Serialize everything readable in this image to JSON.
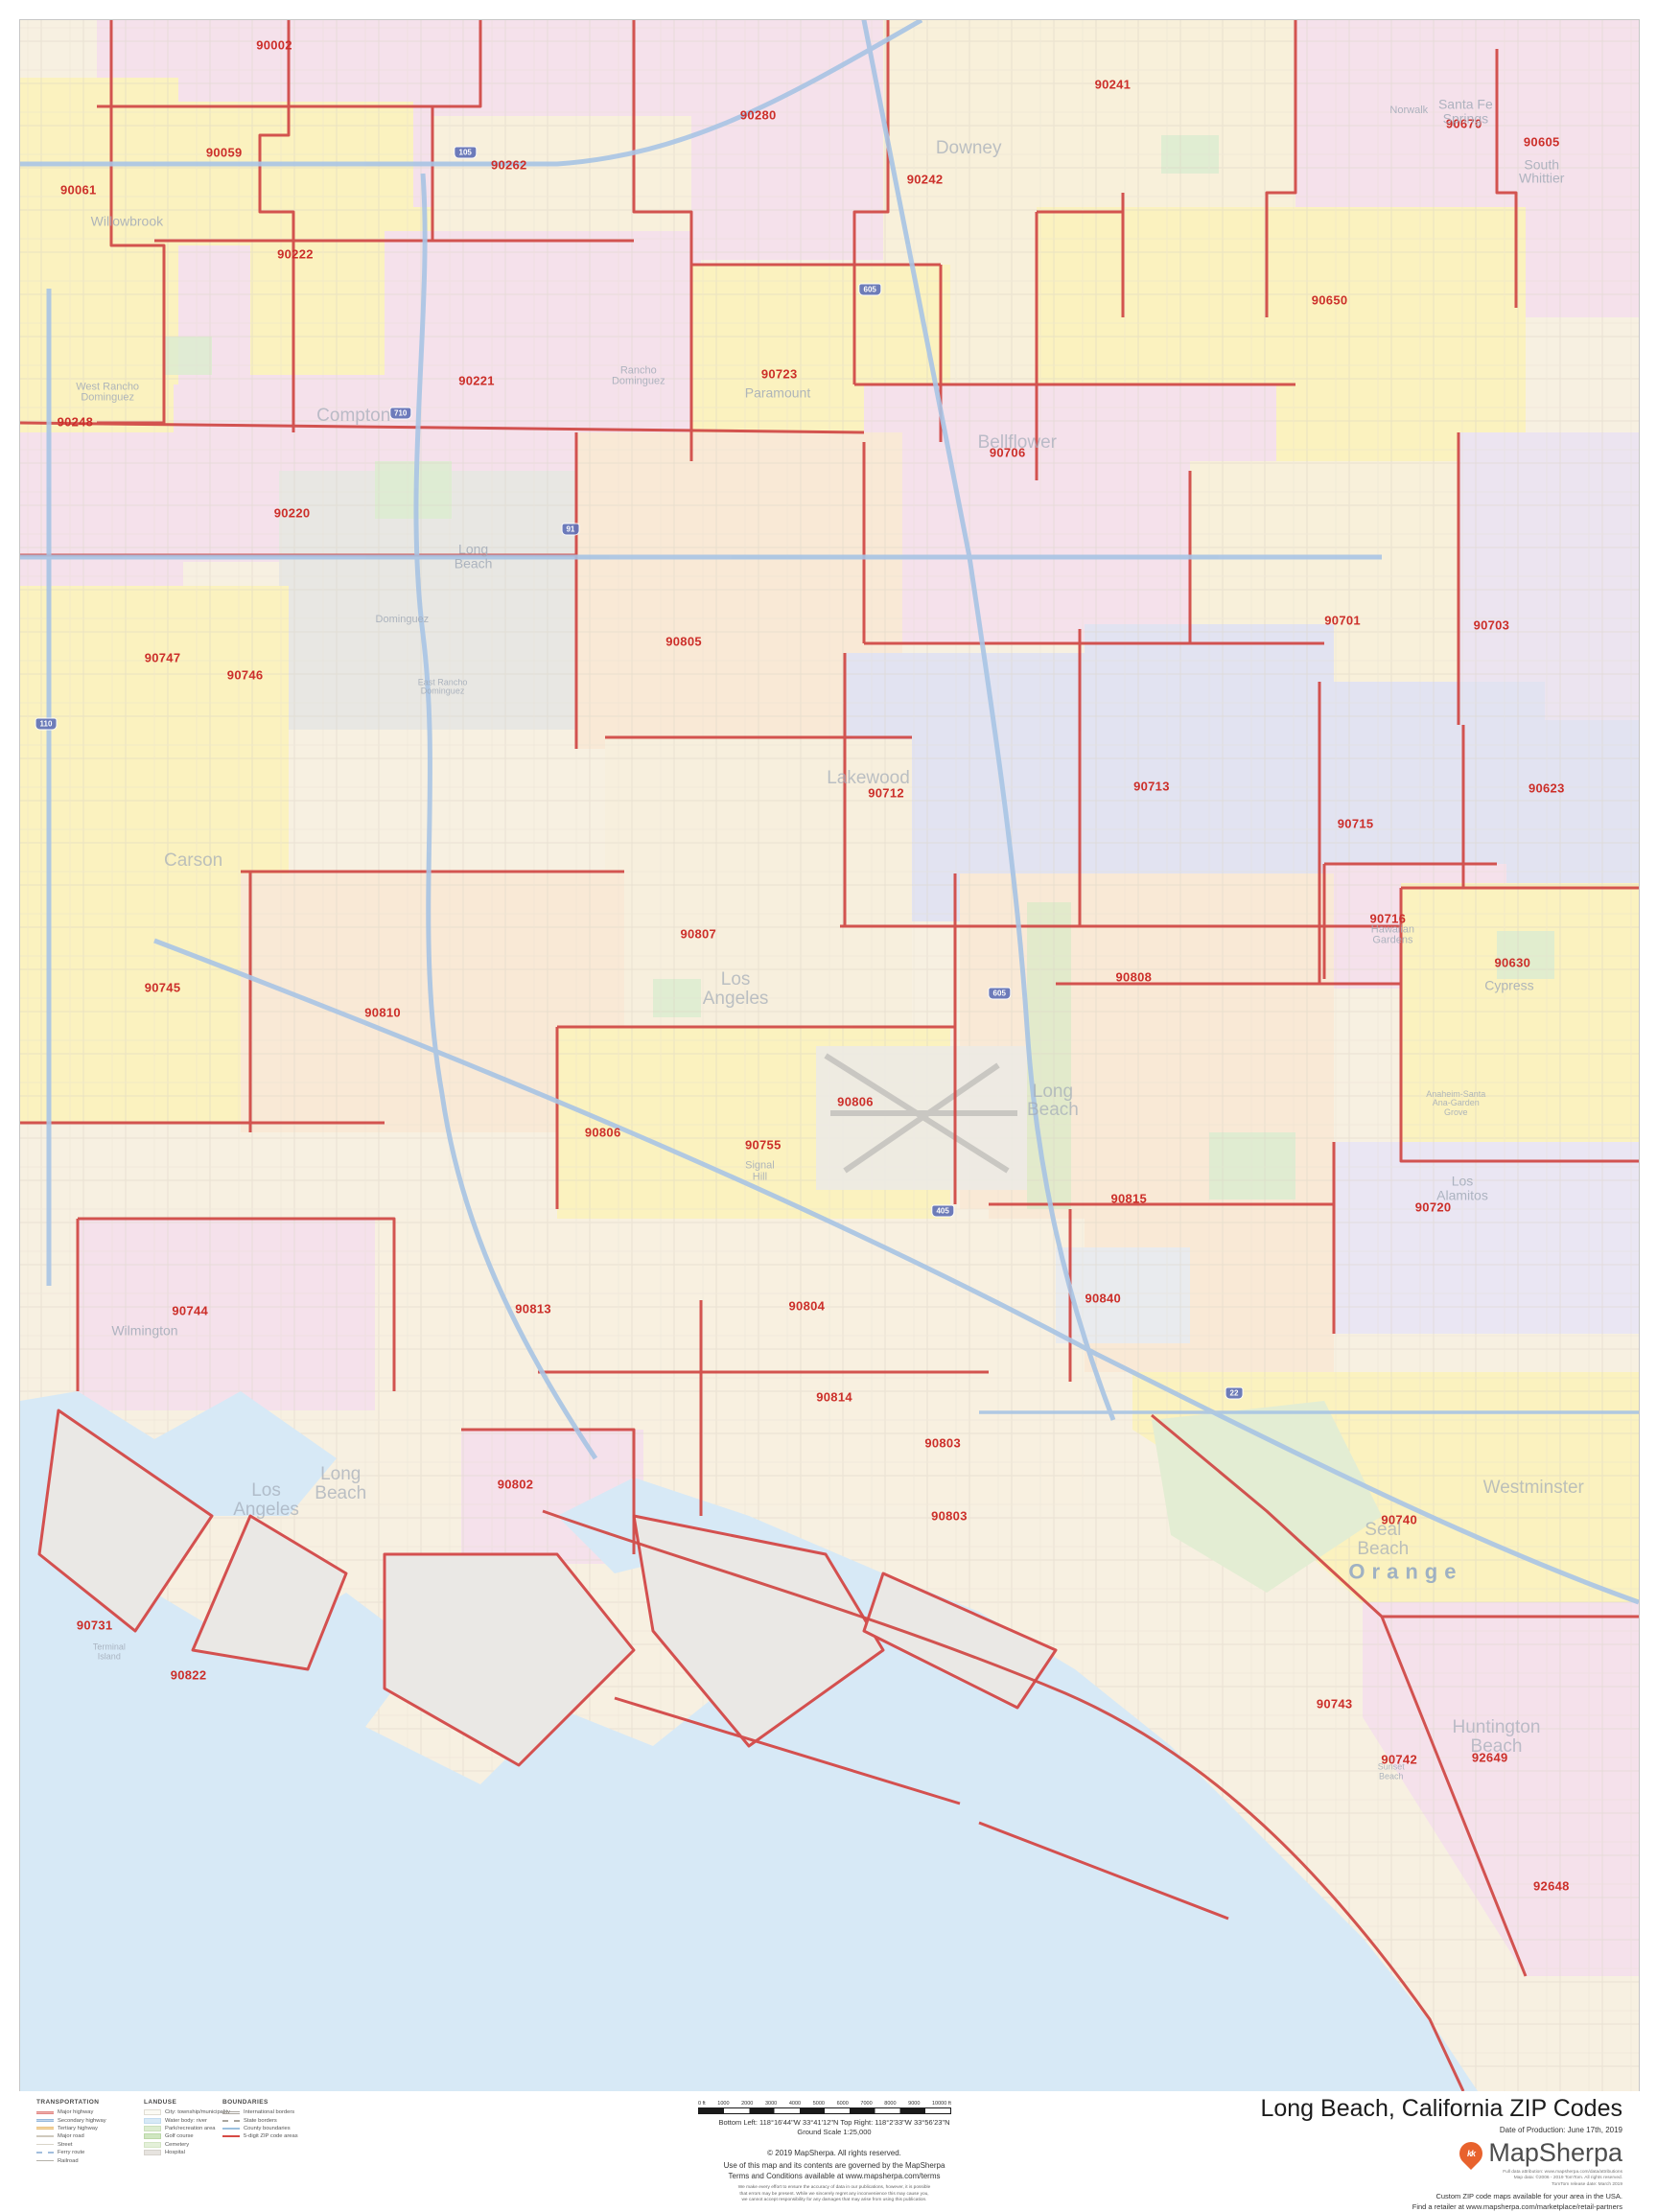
{
  "colors": {
    "zip_label": "#cc2f2a",
    "boundary": "#d14b48",
    "water": "#d7e9f6",
    "city_label": "#a2abb8",
    "county_label": "#8fa6c4",
    "accent": "#e8622d"
  },
  "map": {
    "zip_labels": [
      {
        "code": "90002",
        "x": 15.7,
        "y": 1.2
      },
      {
        "code": "90059",
        "x": 12.6,
        "y": 6.4
      },
      {
        "code": "90061",
        "x": 3.6,
        "y": 8.2
      },
      {
        "code": "90222",
        "x": 17.0,
        "y": 11.3
      },
      {
        "code": "90262",
        "x": 30.2,
        "y": 7.0
      },
      {
        "code": "90280",
        "x": 45.6,
        "y": 4.6
      },
      {
        "code": "90241",
        "x": 67.5,
        "y": 3.1
      },
      {
        "code": "90242",
        "x": 55.9,
        "y": 7.7
      },
      {
        "code": "90670",
        "x": 89.2,
        "y": 5.0
      },
      {
        "code": "90605",
        "x": 94.0,
        "y": 5.9
      },
      {
        "code": "90650",
        "x": 80.9,
        "y": 13.5
      },
      {
        "code": "90221",
        "x": 28.2,
        "y": 17.4
      },
      {
        "code": "90723",
        "x": 46.9,
        "y": 17.1
      },
      {
        "code": "90706",
        "x": 61.0,
        "y": 20.9
      },
      {
        "code": "90248",
        "x": 3.4,
        "y": 19.4
      },
      {
        "code": "90220",
        "x": 16.8,
        "y": 23.8
      },
      {
        "code": "90701",
        "x": 81.7,
        "y": 29.0
      },
      {
        "code": "90703",
        "x": 90.9,
        "y": 29.2
      },
      {
        "code": "90747",
        "x": 8.8,
        "y": 30.8
      },
      {
        "code": "90746",
        "x": 13.9,
        "y": 31.6
      },
      {
        "code": "90805",
        "x": 41.0,
        "y": 30.0
      },
      {
        "code": "90713",
        "x": 69.9,
        "y": 37.0
      },
      {
        "code": "90623",
        "x": 94.3,
        "y": 37.1
      },
      {
        "code": "90712",
        "x": 53.5,
        "y": 37.3
      },
      {
        "code": "90715",
        "x": 82.5,
        "y": 38.8
      },
      {
        "code": "90716",
        "x": 84.5,
        "y": 43.4
      },
      {
        "code": "90630",
        "x": 92.2,
        "y": 45.5
      },
      {
        "code": "90807",
        "x": 41.9,
        "y": 44.1
      },
      {
        "code": "90808",
        "x": 68.8,
        "y": 46.2
      },
      {
        "code": "90745",
        "x": 8.8,
        "y": 46.7
      },
      {
        "code": "90810",
        "x": 22.4,
        "y": 47.9
      },
      {
        "code": "90806",
        "x": 51.6,
        "y": 52.2
      },
      {
        "code": "90806",
        "x": 36.0,
        "y": 53.7
      },
      {
        "code": "90755",
        "x": 45.9,
        "y": 54.3
      },
      {
        "code": "90815",
        "x": 68.5,
        "y": 56.9
      },
      {
        "code": "90720",
        "x": 87.3,
        "y": 57.3
      },
      {
        "code": "90840",
        "x": 66.9,
        "y": 61.7
      },
      {
        "code": "90744",
        "x": 10.5,
        "y": 62.3
      },
      {
        "code": "90813",
        "x": 31.7,
        "y": 62.2
      },
      {
        "code": "90804",
        "x": 48.6,
        "y": 62.1
      },
      {
        "code": "90814",
        "x": 50.3,
        "y": 66.5
      },
      {
        "code": "90803",
        "x": 57.0,
        "y": 68.7
      },
      {
        "code": "90802",
        "x": 30.6,
        "y": 70.7
      },
      {
        "code": "90803",
        "x": 57.4,
        "y": 72.2
      },
      {
        "code": "90740",
        "x": 85.2,
        "y": 72.4
      },
      {
        "code": "90731",
        "x": 4.6,
        "y": 77.5
      },
      {
        "code": "90822",
        "x": 10.4,
        "y": 79.9
      },
      {
        "code": "90743",
        "x": 81.2,
        "y": 81.3
      },
      {
        "code": "90742",
        "x": 85.2,
        "y": 84.0
      },
      {
        "code": "92649",
        "x": 90.8,
        "y": 83.9
      },
      {
        "code": "92648",
        "x": 94.6,
        "y": 90.1
      }
    ],
    "city_labels": [
      {
        "label": "Willowbrook",
        "x": 6.6,
        "y": 9.7,
        "cls": "m"
      },
      {
        "label": "West Rancho\nDominguez",
        "x": 5.4,
        "y": 18.0,
        "cls": "s"
      },
      {
        "label": "Downey",
        "x": 58.6,
        "y": 6.2,
        "cls": "l"
      },
      {
        "label": "Norwalk",
        "x": 85.8,
        "y": 4.4,
        "cls": "s"
      },
      {
        "label": "Santa Fe\nSprings",
        "x": 89.3,
        "y": 4.4,
        "cls": "m"
      },
      {
        "label": "South\nWhittier",
        "x": 94.0,
        "y": 7.3,
        "cls": "m"
      },
      {
        "label": "Compton",
        "x": 20.6,
        "y": 19.1,
        "cls": "l"
      },
      {
        "label": "Rancho\nDominguez",
        "x": 38.2,
        "y": 17.2,
        "cls": "s"
      },
      {
        "label": "Paramount",
        "x": 46.8,
        "y": 18.0,
        "cls": "m"
      },
      {
        "label": "Bellflower",
        "x": 61.6,
        "y": 20.4,
        "cls": "l"
      },
      {
        "label": "Carson",
        "x": 10.7,
        "y": 40.6,
        "cls": "l"
      },
      {
        "label": "Long\nBeach",
        "x": 28.0,
        "y": 25.9,
        "cls": "m"
      },
      {
        "label": "Dominguez",
        "x": 23.6,
        "y": 29.0,
        "cls": "s"
      },
      {
        "label": "East Rancho\nDominguez",
        "x": 26.1,
        "y": 32.2,
        "cls": "xs"
      },
      {
        "label": "Lakewood",
        "x": 52.4,
        "y": 36.6,
        "cls": "l"
      },
      {
        "label": "Los\nAngeles",
        "x": 44.2,
        "y": 46.8,
        "cls": "l"
      },
      {
        "label": "Signal\nHill",
        "x": 45.7,
        "y": 55.6,
        "cls": "s"
      },
      {
        "label": "Long\nBeach",
        "x": 63.8,
        "y": 52.2,
        "cls": "l"
      },
      {
        "label": "Hawaiian\nGardens",
        "x": 84.8,
        "y": 44.2,
        "cls": "s"
      },
      {
        "label": "Cypress",
        "x": 92.0,
        "y": 46.6,
        "cls": "m"
      },
      {
        "label": "Los\nAlamitos",
        "x": 89.1,
        "y": 56.4,
        "cls": "m"
      },
      {
        "label": "Anaheim-Santa\nAna-Garden\nGrove",
        "x": 88.7,
        "y": 52.3,
        "cls": "xs"
      },
      {
        "label": "Wilmington",
        "x": 7.7,
        "y": 63.3,
        "cls": "m"
      },
      {
        "label": "Long\nBeach",
        "x": 19.8,
        "y": 70.7,
        "cls": "l"
      },
      {
        "label": "Los\nAngeles",
        "x": 15.2,
        "y": 71.5,
        "cls": "l"
      },
      {
        "label": "Terminal\nIsland",
        "x": 5.5,
        "y": 78.8,
        "cls": "xs"
      },
      {
        "label": "Westminster",
        "x": 93.5,
        "y": 70.9,
        "cls": "l"
      },
      {
        "label": "Seal\nBeach",
        "x": 84.2,
        "y": 73.4,
        "cls": "l"
      },
      {
        "label": "Orange",
        "x": 85.6,
        "y": 74.9,
        "cls": "county"
      },
      {
        "label": "Huntington\nBeach",
        "x": 91.2,
        "y": 82.9,
        "cls": "l"
      },
      {
        "label": "Sunset\nBeach",
        "x": 84.7,
        "y": 84.6,
        "cls": "xs"
      }
    ],
    "freeway_shields": [
      {
        "num": "105",
        "x": 27.5,
        "y": 6.4
      },
      {
        "num": "710",
        "x": 23.5,
        "y": 19.0
      },
      {
        "num": "605",
        "x": 52.5,
        "y": 13.0
      },
      {
        "num": "91",
        "x": 34.0,
        "y": 24.6
      },
      {
        "num": "405",
        "x": 57.0,
        "y": 57.5
      },
      {
        "num": "110",
        "x": 1.6,
        "y": 34.0
      },
      {
        "num": "605",
        "x": 60.5,
        "y": 47.0
      },
      {
        "num": "22",
        "x": 75.0,
        "y": 66.3
      }
    ]
  },
  "legend": {
    "transportation": {
      "title": "TRANSPORTATION",
      "items": [
        {
          "label": "Major highway",
          "swatch": "height:3px;background:#f0b0ae;border-top:1px solid #e08986;border-bottom:1px solid #e08986"
        },
        {
          "label": "Secondary highway",
          "swatch": "height:3px;background:#c3d7ec;border-top:1px solid #97b9dc;border-bottom:1px solid #97b9dc"
        },
        {
          "label": "Tertiary highway",
          "swatch": "height:3px;background:#f6dcab;border-top:1px solid #e8bf7e;border-bottom:1px solid #e8bf7e"
        },
        {
          "label": "Major road",
          "swatch": "height:2px;background:#cfc9bd"
        },
        {
          "label": "Street",
          "swatch": "height:1px;background:#d9d4c9"
        },
        {
          "label": "Ferry route",
          "swatch": "height:0;border-top:2px dashed #a3bedd"
        },
        {
          "label": "Railroad",
          "swatch": "height:1px;background:#b5b1a9"
        }
      ]
    },
    "landuse": {
      "title": "LANDUSE",
      "items": [
        {
          "label": "City: township/municipality",
          "swatch": "background:#fbfaf4;border:1px solid #e0ddd3"
        },
        {
          "label": "Water body: river",
          "swatch": "background:#d7e9f6;border:1px solid #c3dcef"
        },
        {
          "label": "Park/recreation area",
          "swatch": "background:#dcecd0;border:1px solid #cce0bc"
        },
        {
          "label": "Golf course",
          "swatch": "background:#cfe6c0;border:1px solid #bcd8a9"
        },
        {
          "label": "Cemetery",
          "swatch": "background:#e4f0d9;border:1px solid #d4e5c5"
        },
        {
          "label": "Hospital",
          "swatch": "background:#e6e3df;border:1px solid #d6d2cc"
        }
      ]
    },
    "boundaries": {
      "title": "BOUNDARIES",
      "items": [
        {
          "label": "International borders",
          "swatch": "height:0;border-top:3px double #a9a59e"
        },
        {
          "label": "State borders",
          "swatch": "height:0;border-top:2px dashed #aaa69f"
        },
        {
          "label": "County boundaries",
          "swatch": "height:0;border-top:2px solid #9cc0de"
        },
        {
          "label": "5-digit ZIP code areas",
          "swatch": "height:0;border-top:2px solid #d64b45"
        }
      ]
    }
  },
  "scale": {
    "ticks": [
      "0 ft",
      "1000",
      "2000",
      "3000",
      "4000",
      "5000",
      "6000",
      "7000",
      "8000",
      "9000",
      "10000 ft"
    ]
  },
  "footer": {
    "coordinates": "Bottom Left: 118°16'44\"W 33°41'12\"N  Top Right: 118°2'33\"W 33°56'23\"N\nGround Scale 1:25,000",
    "copyright": "© 2019 MapSherpa. All rights reserved.",
    "terms": "Use of this map and its contents are governed by the MapSherpa\nTerms and Conditions available at www.mapsherpa.com/terms",
    "disclaimer": "We make every effort to ensure the accuracy of data in our publications, however, it is possible\nthat errors may be present. While we sincerely regret any inconvenience this may cause you,\nwe cannot accept responsibility for any damages that may arise from using this publication."
  },
  "title_block": {
    "title": "Long Beach, California ZIP Codes",
    "production": "Date of Production: June 17th, 2019",
    "brand": "MapSherpa",
    "logo_glyph": "kk",
    "attribution": "Full data attribution: www.mapsherpa.com/data/attributions\nMap data: ©2006 - 2019 TomTom. All rights reserved.\nTomTom release date: March 2019",
    "retail": "Custom ZIP code maps available for your area in the USA.\nFind a retailer at www.mapsherpa.com/marketplace/retail-partners"
  }
}
